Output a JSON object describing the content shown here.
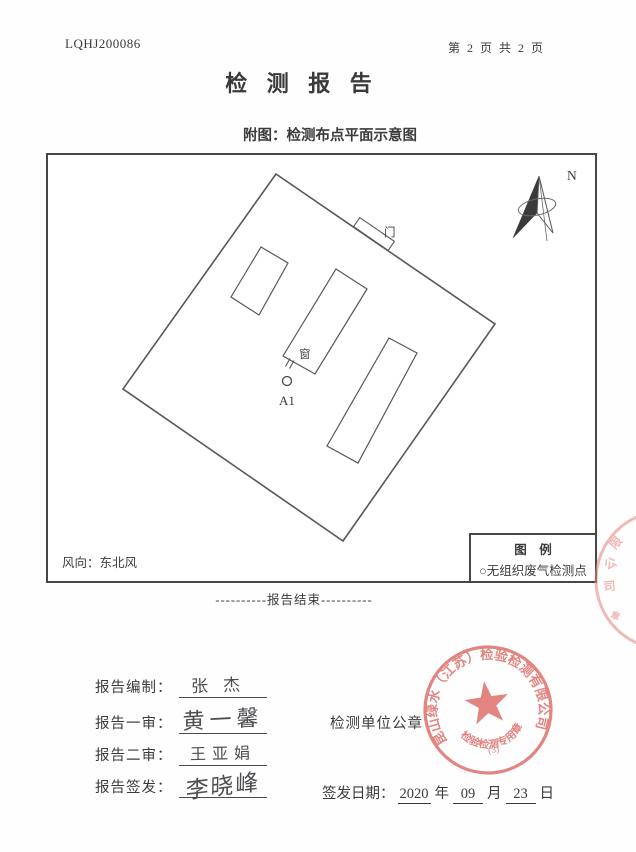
{
  "header": {
    "doc_number": "LQHJ200086",
    "page_indicator": "第 2 页 共 2 页"
  },
  "title": "检 测 报 告",
  "subtitle": "附图：检测布点平面示意图",
  "diagram": {
    "north_label": "N",
    "door_label": "门",
    "window_label": "窗",
    "sample_point_label": "A1",
    "wind_direction": "风向：东北风",
    "legend": {
      "title": "图　例",
      "item": "○无组织废气检测点"
    }
  },
  "end_note": "----------报告结束----------",
  "signatures": {
    "rows": [
      {
        "label": "报告编制：",
        "name": "张杰"
      },
      {
        "label": "报告一审：",
        "name": "黄一馨"
      },
      {
        "label": "报告二审：",
        "name": "王亚娟"
      },
      {
        "label": "报告签发：",
        "name": "李晓峰"
      }
    ]
  },
  "seal_caption": "检测单位公章",
  "issue_date": {
    "label": "签发日期：",
    "year": "2020",
    "year_unit": "年",
    "month": "09",
    "month_unit": "月",
    "day": "23",
    "day_unit": "日"
  },
  "seal": {
    "company": "昆山绿水（江苏）检验检测有限公司",
    "type_text": "检验检测专用章",
    "number": "(3)",
    "color": "#dd6a64"
  },
  "edge_seal": {
    "chars": [
      "限",
      "公",
      "司",
      "章"
    ]
  }
}
